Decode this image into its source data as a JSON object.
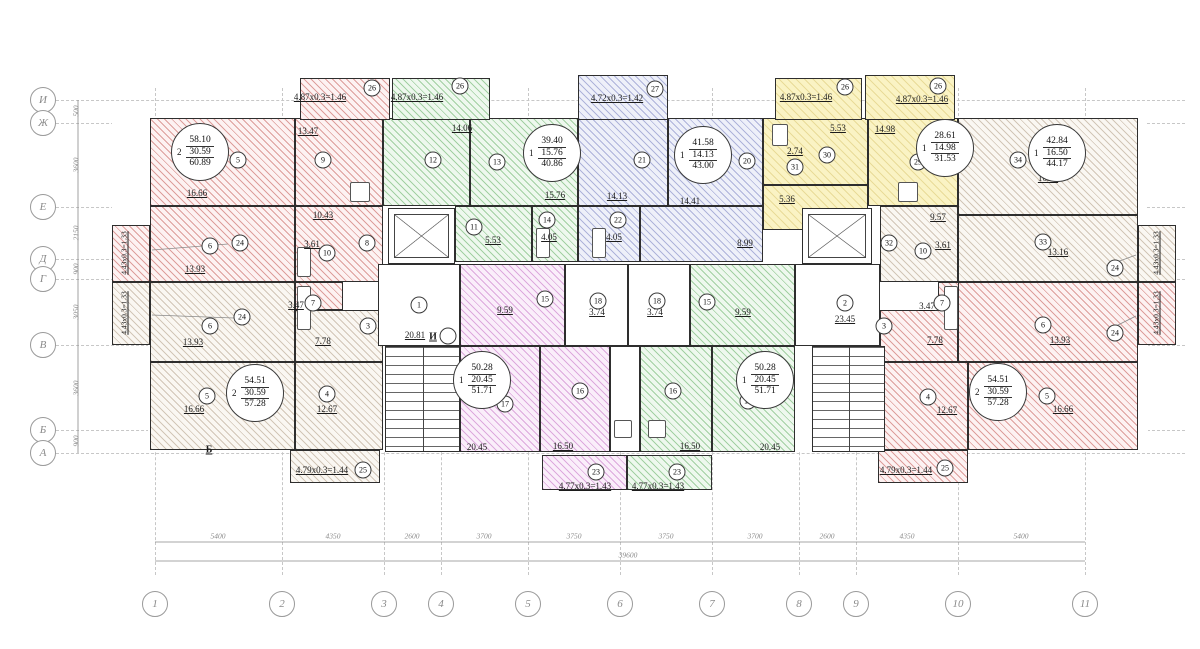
{
  "drawing_type": "residential floor plan, typical storey",
  "plan": {
    "width": 1200,
    "height": 649,
    "colors": {
      "pink": "#e2a7a3",
      "green": "#a8d8a8",
      "blue": "#a9aed6",
      "yellow": "#f4e9a6",
      "purple": "#dcaadc",
      "beige": "#d9cfc0"
    },
    "grid": {
      "v": [
        155,
        282,
        384,
        441,
        528,
        620,
        712,
        799,
        856,
        958,
        1085
      ],
      "vy1": 88,
      "vy2": 575,
      "h": [
        100,
        123,
        207,
        259,
        279,
        345,
        430,
        453
      ],
      "hx1": 56,
      "hx2": 1185
    },
    "axes_bottom": {
      "y": 604,
      "items": [
        {
          "n": "1",
          "x": 155
        },
        {
          "n": "2",
          "x": 282
        },
        {
          "n": "3",
          "x": 384
        },
        {
          "n": "4",
          "x": 441
        },
        {
          "n": "5",
          "x": 528
        },
        {
          "n": "6",
          "x": 620
        },
        {
          "n": "7",
          "x": 712
        },
        {
          "n": "8",
          "x": 799
        },
        {
          "n": "9",
          "x": 856
        },
        {
          "n": "10",
          "x": 958
        },
        {
          "n": "11",
          "x": 1085
        }
      ]
    },
    "axes_left": {
      "x": 43,
      "items": [
        {
          "n": "И",
          "y": 100
        },
        {
          "n": "Ж",
          "y": 123
        },
        {
          "n": "Е",
          "y": 207
        },
        {
          "n": "Д",
          "y": 259
        },
        {
          "n": "Г",
          "y": 279
        },
        {
          "n": "В",
          "y": 345
        },
        {
          "n": "Б",
          "y": 430
        },
        {
          "n": "А",
          "y": 453
        }
      ]
    },
    "dims_bottom": {
      "y": 536,
      "items": [
        {
          "t": "5400",
          "x": 218
        },
        {
          "t": "4350",
          "x": 333
        },
        {
          "t": "2600",
          "x": 412
        },
        {
          "t": "3700",
          "x": 484
        },
        {
          "t": "3750",
          "x": 574
        },
        {
          "t": "3750",
          "x": 666
        },
        {
          "t": "3700",
          "x": 755
        },
        {
          "t": "2600",
          "x": 827
        },
        {
          "t": "4350",
          "x": 907
        },
        {
          "t": "5400",
          "x": 1021
        }
      ],
      "total": {
        "t": "39600",
        "x": 628,
        "y": 555
      }
    },
    "dims_left": {
      "x": 76,
      "items": [
        {
          "t": "500",
          "y": 111
        },
        {
          "t": "3600",
          "y": 165
        },
        {
          "t": "2150",
          "y": 233
        },
        {
          "t": "900",
          "y": 269
        },
        {
          "t": "3050",
          "y": 312
        },
        {
          "t": "3600",
          "y": 388
        },
        {
          "t": "900",
          "y": 441
        }
      ]
    },
    "base": [
      [
        112,
        116,
        846,
        150
      ],
      [
        958,
        116,
        188,
        170
      ],
      [
        148,
        262,
        1000,
        190
      ]
    ],
    "rooms": [
      [
        150,
        118,
        145,
        88,
        "pink"
      ],
      [
        295,
        118,
        88,
        88,
        "pink"
      ],
      [
        150,
        206,
        145,
        76,
        "pink"
      ],
      [
        295,
        206,
        88,
        76,
        "pink"
      ],
      [
        295,
        282,
        48,
        28,
        "pink"
      ],
      [
        150,
        282,
        145,
        80,
        "beige"
      ],
      [
        150,
        362,
        145,
        88,
        "beige"
      ],
      [
        295,
        362,
        88,
        88,
        "beige"
      ],
      [
        295,
        310,
        88,
        52,
        "beige"
      ],
      [
        383,
        118,
        87,
        88,
        "green"
      ],
      [
        470,
        118,
        108,
        88,
        "green"
      ],
      [
        455,
        206,
        77,
        56,
        "green"
      ],
      [
        532,
        206,
        46,
        56,
        "green"
      ],
      [
        578,
        118,
        90,
        88,
        "blue"
      ],
      [
        668,
        118,
        95,
        88,
        "blue"
      ],
      [
        578,
        206,
        62,
        56,
        "blue"
      ],
      [
        640,
        206,
        123,
        56,
        "blue"
      ],
      [
        763,
        118,
        105,
        67,
        "yellow"
      ],
      [
        868,
        118,
        90,
        88,
        "yellow"
      ],
      [
        763,
        185,
        105,
        45,
        "yellow"
      ],
      [
        958,
        118,
        180,
        97,
        "beige"
      ],
      [
        958,
        215,
        180,
        67,
        "beige"
      ],
      [
        880,
        206,
        78,
        76,
        "beige"
      ],
      [
        938,
        282,
        48,
        28,
        "pink"
      ],
      [
        958,
        282,
        180,
        80,
        "pink"
      ],
      [
        880,
        310,
        78,
        52,
        "pink"
      ],
      [
        880,
        362,
        88,
        88,
        "pink"
      ],
      [
        968,
        362,
        170,
        88,
        "pink"
      ],
      [
        460,
        264,
        105,
        82,
        "purple"
      ],
      [
        460,
        346,
        80,
        106,
        "purple"
      ],
      [
        540,
        346,
        70,
        106,
        "purple"
      ],
      [
        690,
        264,
        105,
        82,
        "green"
      ],
      [
        640,
        346,
        72,
        106,
        "green"
      ],
      [
        712,
        346,
        83,
        106,
        "green"
      ],
      [
        565,
        264,
        63,
        82,
        "white"
      ],
      [
        628,
        264,
        62,
        82,
        "white"
      ],
      [
        378,
        264,
        82,
        82,
        "white"
      ],
      [
        795,
        264,
        85,
        82,
        "white"
      ],
      [
        610,
        346,
        30,
        106,
        "white"
      ],
      [
        112,
        225,
        38,
        57,
        "pink"
      ],
      [
        112,
        282,
        38,
        63,
        "beige"
      ],
      [
        1138,
        225,
        38,
        57,
        "beige"
      ],
      [
        1138,
        282,
        38,
        63,
        "pink"
      ]
    ],
    "balconies": [
      [
        300,
        78,
        90,
        42,
        "pink"
      ],
      [
        392,
        78,
        98,
        42,
        "green"
      ],
      [
        578,
        75,
        90,
        45,
        "blue"
      ],
      [
        775,
        78,
        87,
        42,
        "yellow"
      ],
      [
        865,
        75,
        90,
        45,
        "yellow"
      ],
      [
        290,
        450,
        90,
        33,
        "beige"
      ],
      [
        542,
        455,
        85,
        35,
        "purple"
      ],
      [
        627,
        455,
        85,
        35,
        "green"
      ],
      [
        878,
        450,
        90,
        33,
        "pink"
      ]
    ],
    "elevators": [
      [
        388,
        208,
        67,
        56
      ],
      [
        802,
        208,
        70,
        56
      ]
    ],
    "stairs": [
      [
        385,
        346,
        75,
        106
      ],
      [
        812,
        346,
        73,
        106
      ]
    ],
    "fixtures": [
      [
        297,
        247,
        14,
        30
      ],
      [
        297,
        286,
        14,
        44
      ],
      [
        944,
        286,
        14,
        44
      ],
      [
        536,
        228,
        14,
        30
      ],
      [
        592,
        228,
        14,
        30
      ],
      [
        350,
        182,
        20,
        20
      ],
      [
        898,
        182,
        20,
        20
      ],
      [
        614,
        420,
        18,
        18
      ],
      [
        648,
        420,
        18,
        18
      ],
      [
        772,
        124,
        16,
        22
      ]
    ],
    "lines": [
      [
        155,
        542,
        1085,
        542
      ],
      [
        155,
        561,
        1085,
        561
      ],
      [
        78,
        100,
        78,
        453
      ],
      [
        152,
        250,
        228,
        244
      ],
      [
        152,
        315,
        234,
        318
      ],
      [
        1136,
        255,
        1106,
        266
      ],
      [
        1136,
        316,
        1106,
        331
      ]
    ],
    "area_labels": [
      {
        "t": "16.66",
        "x": 197,
        "y": 193,
        "u": 1
      },
      {
        "t": "13.47",
        "x": 308,
        "y": 131,
        "u": 1
      },
      {
        "t": "14.06",
        "x": 462,
        "y": 128,
        "u": 1
      },
      {
        "t": "15.76",
        "x": 555,
        "y": 195,
        "u": 1
      },
      {
        "t": "14.13",
        "x": 617,
        "y": 196,
        "u": 1
      },
      {
        "t": "14.41",
        "x": 690,
        "y": 201,
        "u": 1
      },
      {
        "t": "5.53",
        "x": 838,
        "y": 128,
        "u": 1
      },
      {
        "t": "14.98",
        "x": 885,
        "y": 129,
        "u": 1
      },
      {
        "t": "2.74",
        "x": 795,
        "y": 151,
        "u": 1
      },
      {
        "t": "16.50",
        "x": 1048,
        "y": 178,
        "u": 1
      },
      {
        "t": "10.43",
        "x": 323,
        "y": 215,
        "u": 1
      },
      {
        "t": "5.53",
        "x": 493,
        "y": 240,
        "u": 1
      },
      {
        "t": "4.05",
        "x": 549,
        "y": 237,
        "u": 1
      },
      {
        "t": "4.05",
        "x": 614,
        "y": 237,
        "u": 1
      },
      {
        "t": "8.99",
        "x": 745,
        "y": 243,
        "u": 1
      },
      {
        "t": "5.36",
        "x": 787,
        "y": 199,
        "u": 1
      },
      {
        "t": "9.57",
        "x": 938,
        "y": 217,
        "u": 1
      },
      {
        "t": "3.61",
        "x": 943,
        "y": 245,
        "u": 1
      },
      {
        "t": "13.16",
        "x": 1058,
        "y": 252,
        "u": 1
      },
      {
        "t": "3.61",
        "x": 312,
        "y": 244,
        "u": 1
      },
      {
        "t": "13.93",
        "x": 195,
        "y": 269,
        "u": 1
      },
      {
        "t": "13.93",
        "x": 193,
        "y": 342,
        "u": 1
      },
      {
        "t": "3.47",
        "x": 296,
        "y": 305,
        "u": 1
      },
      {
        "t": "3.47",
        "x": 927,
        "y": 306,
        "u": 1
      },
      {
        "t": "20.81",
        "x": 415,
        "y": 335,
        "u": 1
      },
      {
        "t": "23.45",
        "x": 845,
        "y": 319,
        "u": 1
      },
      {
        "t": "9.59",
        "x": 505,
        "y": 310,
        "u": 1
      },
      {
        "t": "9.59",
        "x": 743,
        "y": 312,
        "u": 1
      },
      {
        "t": "3.74",
        "x": 597,
        "y": 312,
        "u": 1
      },
      {
        "t": "3.74",
        "x": 655,
        "y": 312,
        "u": 1
      },
      {
        "t": "7.78",
        "x": 323,
        "y": 341,
        "u": 1
      },
      {
        "t": "7.78",
        "x": 935,
        "y": 340,
        "u": 1
      },
      {
        "t": "13.93",
        "x": 1060,
        "y": 340,
        "u": 1
      },
      {
        "t": "16.66",
        "x": 194,
        "y": 409,
        "u": 1
      },
      {
        "t": "12.67",
        "x": 327,
        "y": 409,
        "u": 1
      },
      {
        "t": "12.67",
        "x": 947,
        "y": 410,
        "u": 1
      },
      {
        "t": "16.66",
        "x": 1063,
        "y": 409,
        "u": 1
      },
      {
        "t": "20.45",
        "x": 477,
        "y": 447,
        "u": 1
      },
      {
        "t": "16.50",
        "x": 563,
        "y": 446,
        "u": 1
      },
      {
        "t": "16.50",
        "x": 690,
        "y": 446,
        "u": 1
      },
      {
        "t": "20.45",
        "x": 770,
        "y": 447,
        "u": 1
      },
      {
        "t": "4.87х0.3=1.46",
        "x": 320,
        "y": 97,
        "u": 1
      },
      {
        "t": "4.87х0.3=1.46",
        "x": 417,
        "y": 97,
        "u": 1
      },
      {
        "t": "4.72х0.3=1.42",
        "x": 617,
        "y": 98,
        "u": 1
      },
      {
        "t": "4.87х0.3=1.46",
        "x": 806,
        "y": 97,
        "u": 1
      },
      {
        "t": "4.87х0.3=1.46",
        "x": 922,
        "y": 99,
        "u": 1
      },
      {
        "t": "4.79х0.3=1.44",
        "x": 322,
        "y": 470,
        "u": 1
      },
      {
        "t": "4.77х0.3=1.43",
        "x": 585,
        "y": 486,
        "u": 1
      },
      {
        "t": "4.77х0.3=1.43",
        "x": 658,
        "y": 486,
        "u": 1
      },
      {
        "t": "4.79х0.3=1.44",
        "x": 906,
        "y": 470,
        "u": 1
      },
      {
        "t": "4.43х0.3=1.33",
        "x": 124,
        "y": 253,
        "u": 1,
        "rot": 1
      },
      {
        "t": "4.43х0.3=1.33",
        "x": 124,
        "y": 313,
        "u": 1,
        "rot": 1
      },
      {
        "t": "4.43х0.3=1.33",
        "x": 1156,
        "y": 253,
        "u": 1,
        "rot": 1
      },
      {
        "t": "4.43х0.3=1.33",
        "x": 1156,
        "y": 313,
        "u": 1,
        "rot": 1
      },
      {
        "t": "И",
        "x": 433,
        "y": 337,
        "sec": 1,
        "u": 1
      },
      {
        "t": "Б",
        "x": 209,
        "y": 450,
        "sec": 1,
        "u": 1
      }
    ],
    "room_marks": [
      {
        "n": "5",
        "x": 238,
        "y": 160
      },
      {
        "n": "9",
        "x": 323,
        "y": 160
      },
      {
        "n": "12",
        "x": 433,
        "y": 160
      },
      {
        "n": "13",
        "x": 497,
        "y": 162
      },
      {
        "n": "21",
        "x": 642,
        "y": 160
      },
      {
        "n": "20",
        "x": 747,
        "y": 161
      },
      {
        "n": "30",
        "x": 827,
        "y": 155
      },
      {
        "n": "31",
        "x": 795,
        "y": 167
      },
      {
        "n": "29",
        "x": 918,
        "y": 162
      },
      {
        "n": "34",
        "x": 1018,
        "y": 160
      },
      {
        "n": "26",
        "x": 372,
        "y": 88
      },
      {
        "n": "26",
        "x": 460,
        "y": 86
      },
      {
        "n": "27",
        "x": 655,
        "y": 89
      },
      {
        "n": "26",
        "x": 845,
        "y": 87
      },
      {
        "n": "26",
        "x": 938,
        "y": 86
      },
      {
        "n": "8",
        "x": 367,
        "y": 243
      },
      {
        "n": "11",
        "x": 474,
        "y": 227
      },
      {
        "n": "14",
        "x": 547,
        "y": 220
      },
      {
        "n": "22",
        "x": 618,
        "y": 220
      },
      {
        "n": "6",
        "x": 210,
        "y": 246
      },
      {
        "n": "10",
        "x": 327,
        "y": 253
      },
      {
        "n": "7",
        "x": 313,
        "y": 303
      },
      {
        "n": "24",
        "x": 240,
        "y": 243
      },
      {
        "n": "24",
        "x": 242,
        "y": 317
      },
      {
        "n": "6",
        "x": 210,
        "y": 326
      },
      {
        "n": "3",
        "x": 368,
        "y": 326
      },
      {
        "n": "1",
        "x": 419,
        "y": 305
      },
      {
        "n": "15",
        "x": 545,
        "y": 299
      },
      {
        "n": "18",
        "x": 598,
        "y": 301
      },
      {
        "n": "18",
        "x": 657,
        "y": 301
      },
      {
        "n": "15",
        "x": 707,
        "y": 302
      },
      {
        "n": "2",
        "x": 845,
        "y": 303
      },
      {
        "n": "32",
        "x": 889,
        "y": 243
      },
      {
        "n": "10",
        "x": 923,
        "y": 251
      },
      {
        "n": "33",
        "x": 1043,
        "y": 242
      },
      {
        "n": "7",
        "x": 942,
        "y": 303
      },
      {
        "n": "3",
        "x": 884,
        "y": 326
      },
      {
        "n": "6",
        "x": 1043,
        "y": 325
      },
      {
        "n": "24",
        "x": 1115,
        "y": 268
      },
      {
        "n": "24",
        "x": 1115,
        "y": 333
      },
      {
        "n": "5",
        "x": 207,
        "y": 396
      },
      {
        "n": "4",
        "x": 327,
        "y": 394
      },
      {
        "n": "17",
        "x": 505,
        "y": 404
      },
      {
        "n": "16",
        "x": 580,
        "y": 391
      },
      {
        "n": "16",
        "x": 673,
        "y": 391
      },
      {
        "n": "17",
        "x": 748,
        "y": 401
      },
      {
        "n": "4",
        "x": 928,
        "y": 397
      },
      {
        "n": "5",
        "x": 1047,
        "y": 396
      },
      {
        "n": "25",
        "x": 363,
        "y": 470
      },
      {
        "n": "23",
        "x": 596,
        "y": 472
      },
      {
        "n": "23",
        "x": 677,
        "y": 472
      },
      {
        "n": "25",
        "x": 945,
        "y": 468
      },
      {
        "n": "",
        "x": 448,
        "y": 336
      }
    ],
    "apartment_stamps": [
      {
        "x": 200,
        "y": 152,
        "rooms": "2",
        "total": "58.10",
        "living": "30.59",
        "with_balcony": "60.89"
      },
      {
        "x": 552,
        "y": 153,
        "rooms": "1",
        "total": "39.40",
        "living": "15.76",
        "with_balcony": "40.86"
      },
      {
        "x": 703,
        "y": 155,
        "rooms": "1",
        "total": "41.58",
        "living": "14.13",
        "with_balcony": "43.00"
      },
      {
        "x": 945,
        "y": 148,
        "rooms": "1",
        "total": "28.61",
        "living": "14.98",
        "with_balcony": "31.53"
      },
      {
        "x": 1057,
        "y": 153,
        "rooms": "1",
        "total": "42.84",
        "living": "16.50",
        "with_balcony": "44.17"
      },
      {
        "x": 255,
        "y": 393,
        "rooms": "2",
        "total": "54.51",
        "living": "30.59",
        "with_balcony": "57.28"
      },
      {
        "x": 482,
        "y": 380,
        "rooms": "1",
        "total": "50.28",
        "living": "20.45",
        "with_balcony": "51.71"
      },
      {
        "x": 765,
        "y": 380,
        "rooms": "1",
        "total": "50.28",
        "living": "20.45",
        "with_balcony": "51.71"
      },
      {
        "x": 998,
        "y": 392,
        "rooms": "2",
        "total": "54.51",
        "living": "30.59",
        "with_balcony": "57.28"
      }
    ]
  }
}
